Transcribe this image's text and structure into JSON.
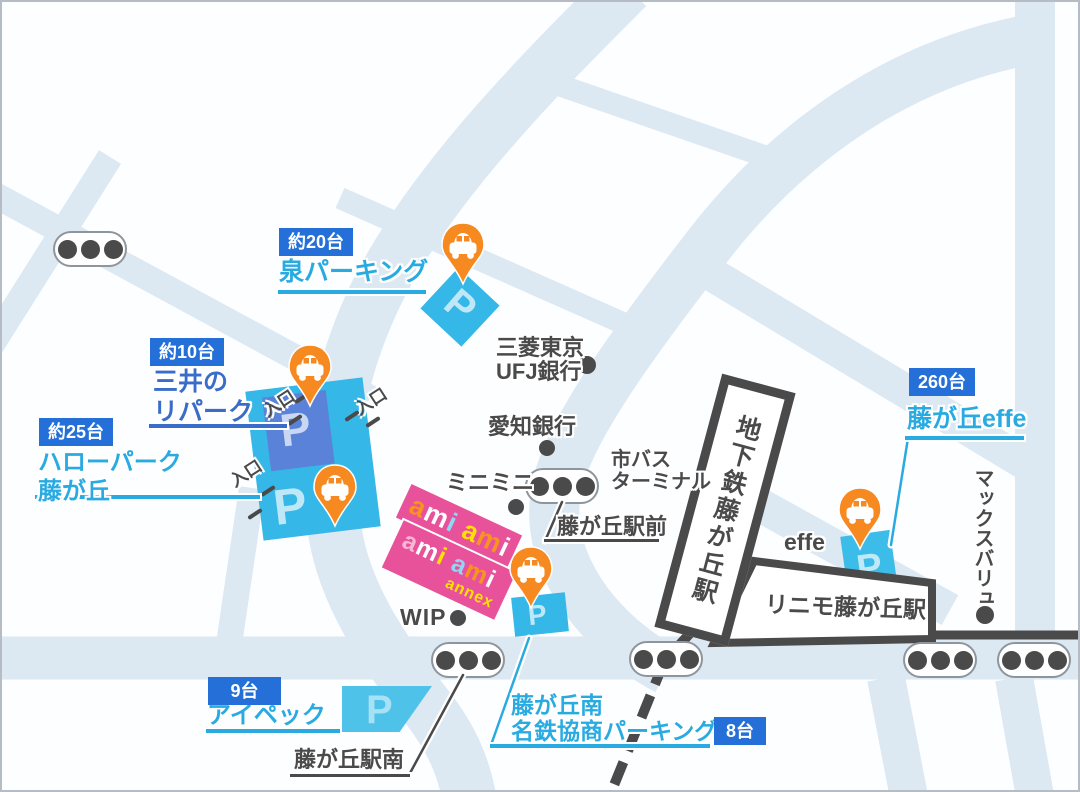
{
  "colors": {
    "road": "#dce8f2",
    "badge_blue": "#2470d8",
    "cyan_text": "#29abe2",
    "mitsui_blue": "#3a6cc9",
    "dark": "#4a4a4a",
    "pin_orange": "#f6891f",
    "lot_cyan": "#35b7e7",
    "lot_blue": "#5a82d8",
    "lot_cyan_light": "#4fc2ea",
    "banner_pink": "#e8529b"
  },
  "misc": {
    "parking_letter": "P",
    "entrance_label": "入口"
  },
  "parkings": {
    "izumi": {
      "badge": "約20台",
      "name": "泉パーキング"
    },
    "mitsui": {
      "badge": "約10台",
      "name_line1": "三井の",
      "name_line2": "リパーク"
    },
    "hello": {
      "badge": "約25台",
      "name_line1": "ハローパーク",
      "name_line2": "藤が丘"
    },
    "ipec": {
      "badge": "9台",
      "name": "アイペック"
    },
    "minami": {
      "badge": "8台",
      "name_line1": "藤が丘南",
      "name_line2": "名鉄協商パーキング"
    },
    "effe": {
      "badge": "260台",
      "name": "藤が丘effe"
    }
  },
  "landmarks": {
    "bank_mufg_line1": "三菱東京",
    "bank_mufg_line2": "UFJ銀行",
    "bank_aichi": "愛知銀行",
    "minimini": "ミニミニ",
    "bus_line1": "市バス",
    "bus_line2": "ターミナル",
    "wip": "WIP",
    "effe_store": "effe",
    "maxvalu": "マックスバリュ"
  },
  "streets": {
    "ekimae": "藤が丘駅前",
    "ekiminami": "藤が丘駅南"
  },
  "stations": {
    "subway": "地下鉄藤が丘駅",
    "linimo": "リニモ藤が丘駅"
  },
  "ami": {
    "banner1": [
      {
        "ch": "a",
        "color": "#f7941d"
      },
      {
        "ch": "m",
        "color": "#ffffff"
      },
      {
        "ch": "i",
        "color": "#8fd7f4"
      },
      {
        "ch": " ",
        "color": "#ffffff"
      },
      {
        "ch": "a",
        "color": "#ffe100"
      },
      {
        "ch": "m",
        "color": "#f7941d"
      },
      {
        "ch": "i",
        "color": "#ffffff"
      }
    ],
    "banner2_line1": [
      {
        "ch": "a",
        "color": "#f8b8d4"
      },
      {
        "ch": "m",
        "color": "#ffffff"
      },
      {
        "ch": "i",
        "color": "#ffe100"
      },
      {
        "ch": " ",
        "color": "#ffffff"
      },
      {
        "ch": "a",
        "color": "#8fd7f4"
      },
      {
        "ch": "m",
        "color": "#f7941d"
      },
      {
        "ch": "i",
        "color": "#ffffff"
      }
    ],
    "banner2_line2": "annex"
  }
}
